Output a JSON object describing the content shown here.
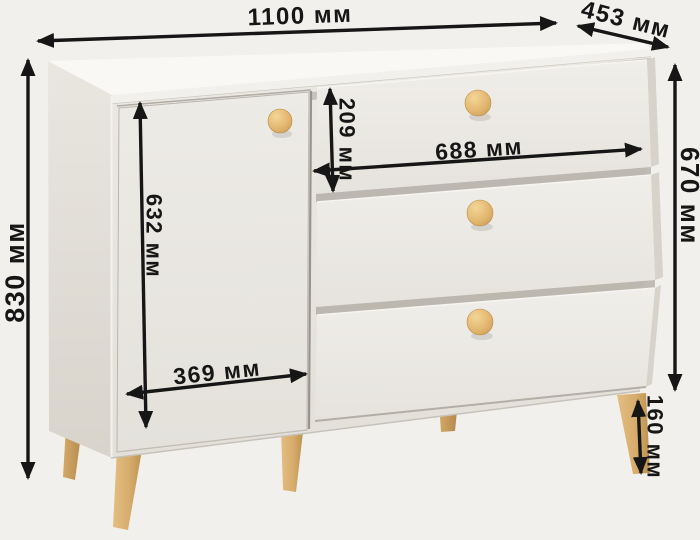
{
  "diagram": {
    "subject": "chest-of-drawers-with-dimensions",
    "unit": "мм"
  },
  "measurements": {
    "overall_width": {
      "value": 1100,
      "unit": "мм",
      "label": "1100 мм"
    },
    "depth": {
      "value": 453,
      "unit": "мм",
      "label": "453 мм"
    },
    "overall_height": {
      "value": 830,
      "unit": "мм",
      "label": "830 мм"
    },
    "body_height": {
      "value": 670,
      "unit": "мм",
      "label": "670 мм"
    },
    "leg_height": {
      "value": 160,
      "unit": "мм",
      "label": "160 мм"
    },
    "door_height": {
      "value": 632,
      "unit": "мм",
      "label": "632 мм"
    },
    "door_width": {
      "value": 369,
      "unit": "мм",
      "label": "369 мм"
    },
    "drawer_width": {
      "value": 688,
      "unit": "мм",
      "label": "688 мм"
    },
    "top_drawer_height": {
      "value": 209,
      "unit": "мм",
      "label": "209 мм"
    }
  },
  "colors": {
    "annotation": "#161616",
    "background": "#f2f0ed",
    "cabinet_front": "#e9e6e1",
    "wood_knob": "#e2b56e",
    "wood_leg": "#d7ad6d"
  }
}
